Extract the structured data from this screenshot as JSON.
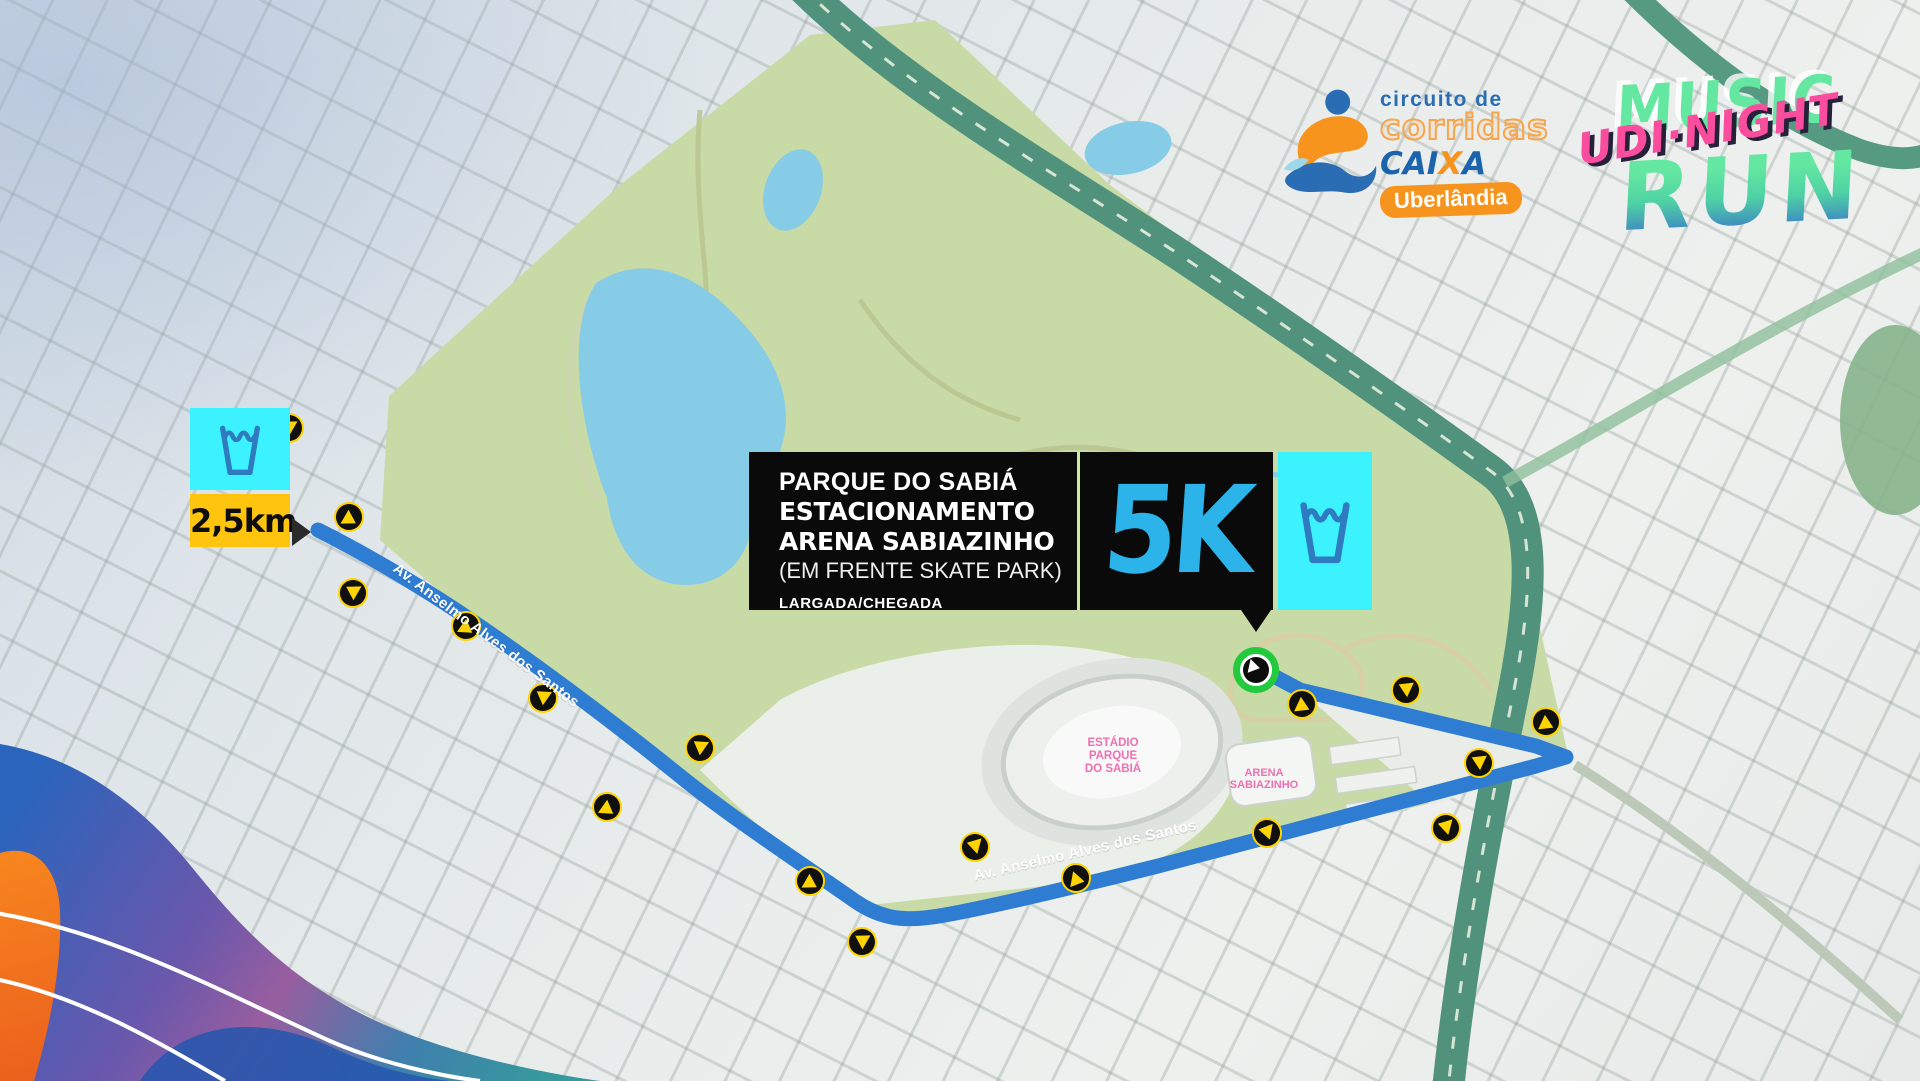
{
  "event": {
    "distance": "5K",
    "location": {
      "line1": "PARQUE DO SABIÁ",
      "line2": "ESTACIONAMENTO",
      "line3": "ARENA SABIAZINHO",
      "line4": "(EM FRENTE SKATE PARK)"
    },
    "start_finish": "LARGADA/CHEGADA"
  },
  "water_station": {
    "km_label": "2,5km"
  },
  "streets": {
    "avenue_upper": "Av. Anselmo Alves dos Santos",
    "avenue_lower": "Av. Anselmo Alves dos Santos"
  },
  "places": {
    "stadium": {
      "line1": "ESTÁDIO",
      "line2": "PARQUE",
      "line3": "DO SABIÁ"
    },
    "arena": {
      "line1": "ARENA",
      "line2": "SABIAZINHO"
    }
  },
  "logos": {
    "circuit": {
      "tagline": "circuito de",
      "name": "corridas",
      "brand_prefix": "CAI",
      "brand_x": "X",
      "brand_suffix": "A",
      "city": "Uberlândia"
    },
    "race": {
      "top": "MUSIC",
      "middle": "UDI·NIGHT",
      "bottom": "RUN"
    }
  },
  "icons": {
    "water_cup": "water-cup-icon",
    "direction_arrow": "direction-arrow-icon",
    "start_finish_marker": "start-finish-marker",
    "runner": "runner-icon"
  },
  "colors": {
    "route_blue": "#2e7dd3",
    "water_box_cyan": "#3df2ff",
    "cup_blue": "#2e7bc0",
    "km_badge_yellow": "#ffc40d",
    "distance_cyan": "#2cb3ea",
    "start_marker_green": "#23ca3e",
    "panel_black": "#0a0a0a",
    "place_label_pink": "#ef6fb2",
    "logo_orange": "#f7941e",
    "logo_blue": "#2a6db5",
    "race_green": "#63e7a1",
    "race_pink": "#fa4d9e",
    "park_green": "#c8daa6",
    "lake_blue": "#87cce6",
    "highway_teal": "#50927c"
  }
}
